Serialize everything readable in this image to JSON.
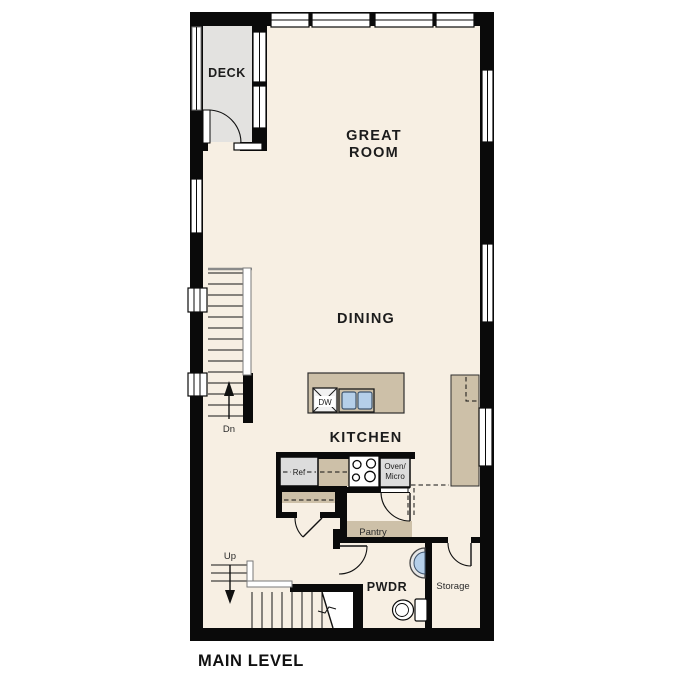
{
  "title": "MAIN LEVEL",
  "rooms": {
    "deck": "DECK",
    "great_line1": "GREAT",
    "great_line2": "ROOM",
    "dining": "DINING",
    "kitchen": "KITCHEN",
    "pwdr": "PWDR",
    "storage": "Storage",
    "pantry": "Pantry"
  },
  "fixtures": {
    "dishwasher": "DW",
    "refrigerator": "Ref",
    "oven_line1": "Oven/",
    "oven_line2": "Micro"
  },
  "stairs": {
    "down": "Dn",
    "up": "Up"
  },
  "colors": {
    "wall": "#0a0a0a",
    "floor": "#f7efe3",
    "deck": "#e3e2e0",
    "counter": "#cdc0a8",
    "appliance": "#dcdcdc",
    "sink_blue": "#b5cfe9",
    "sink_border": "#3f556e"
  }
}
